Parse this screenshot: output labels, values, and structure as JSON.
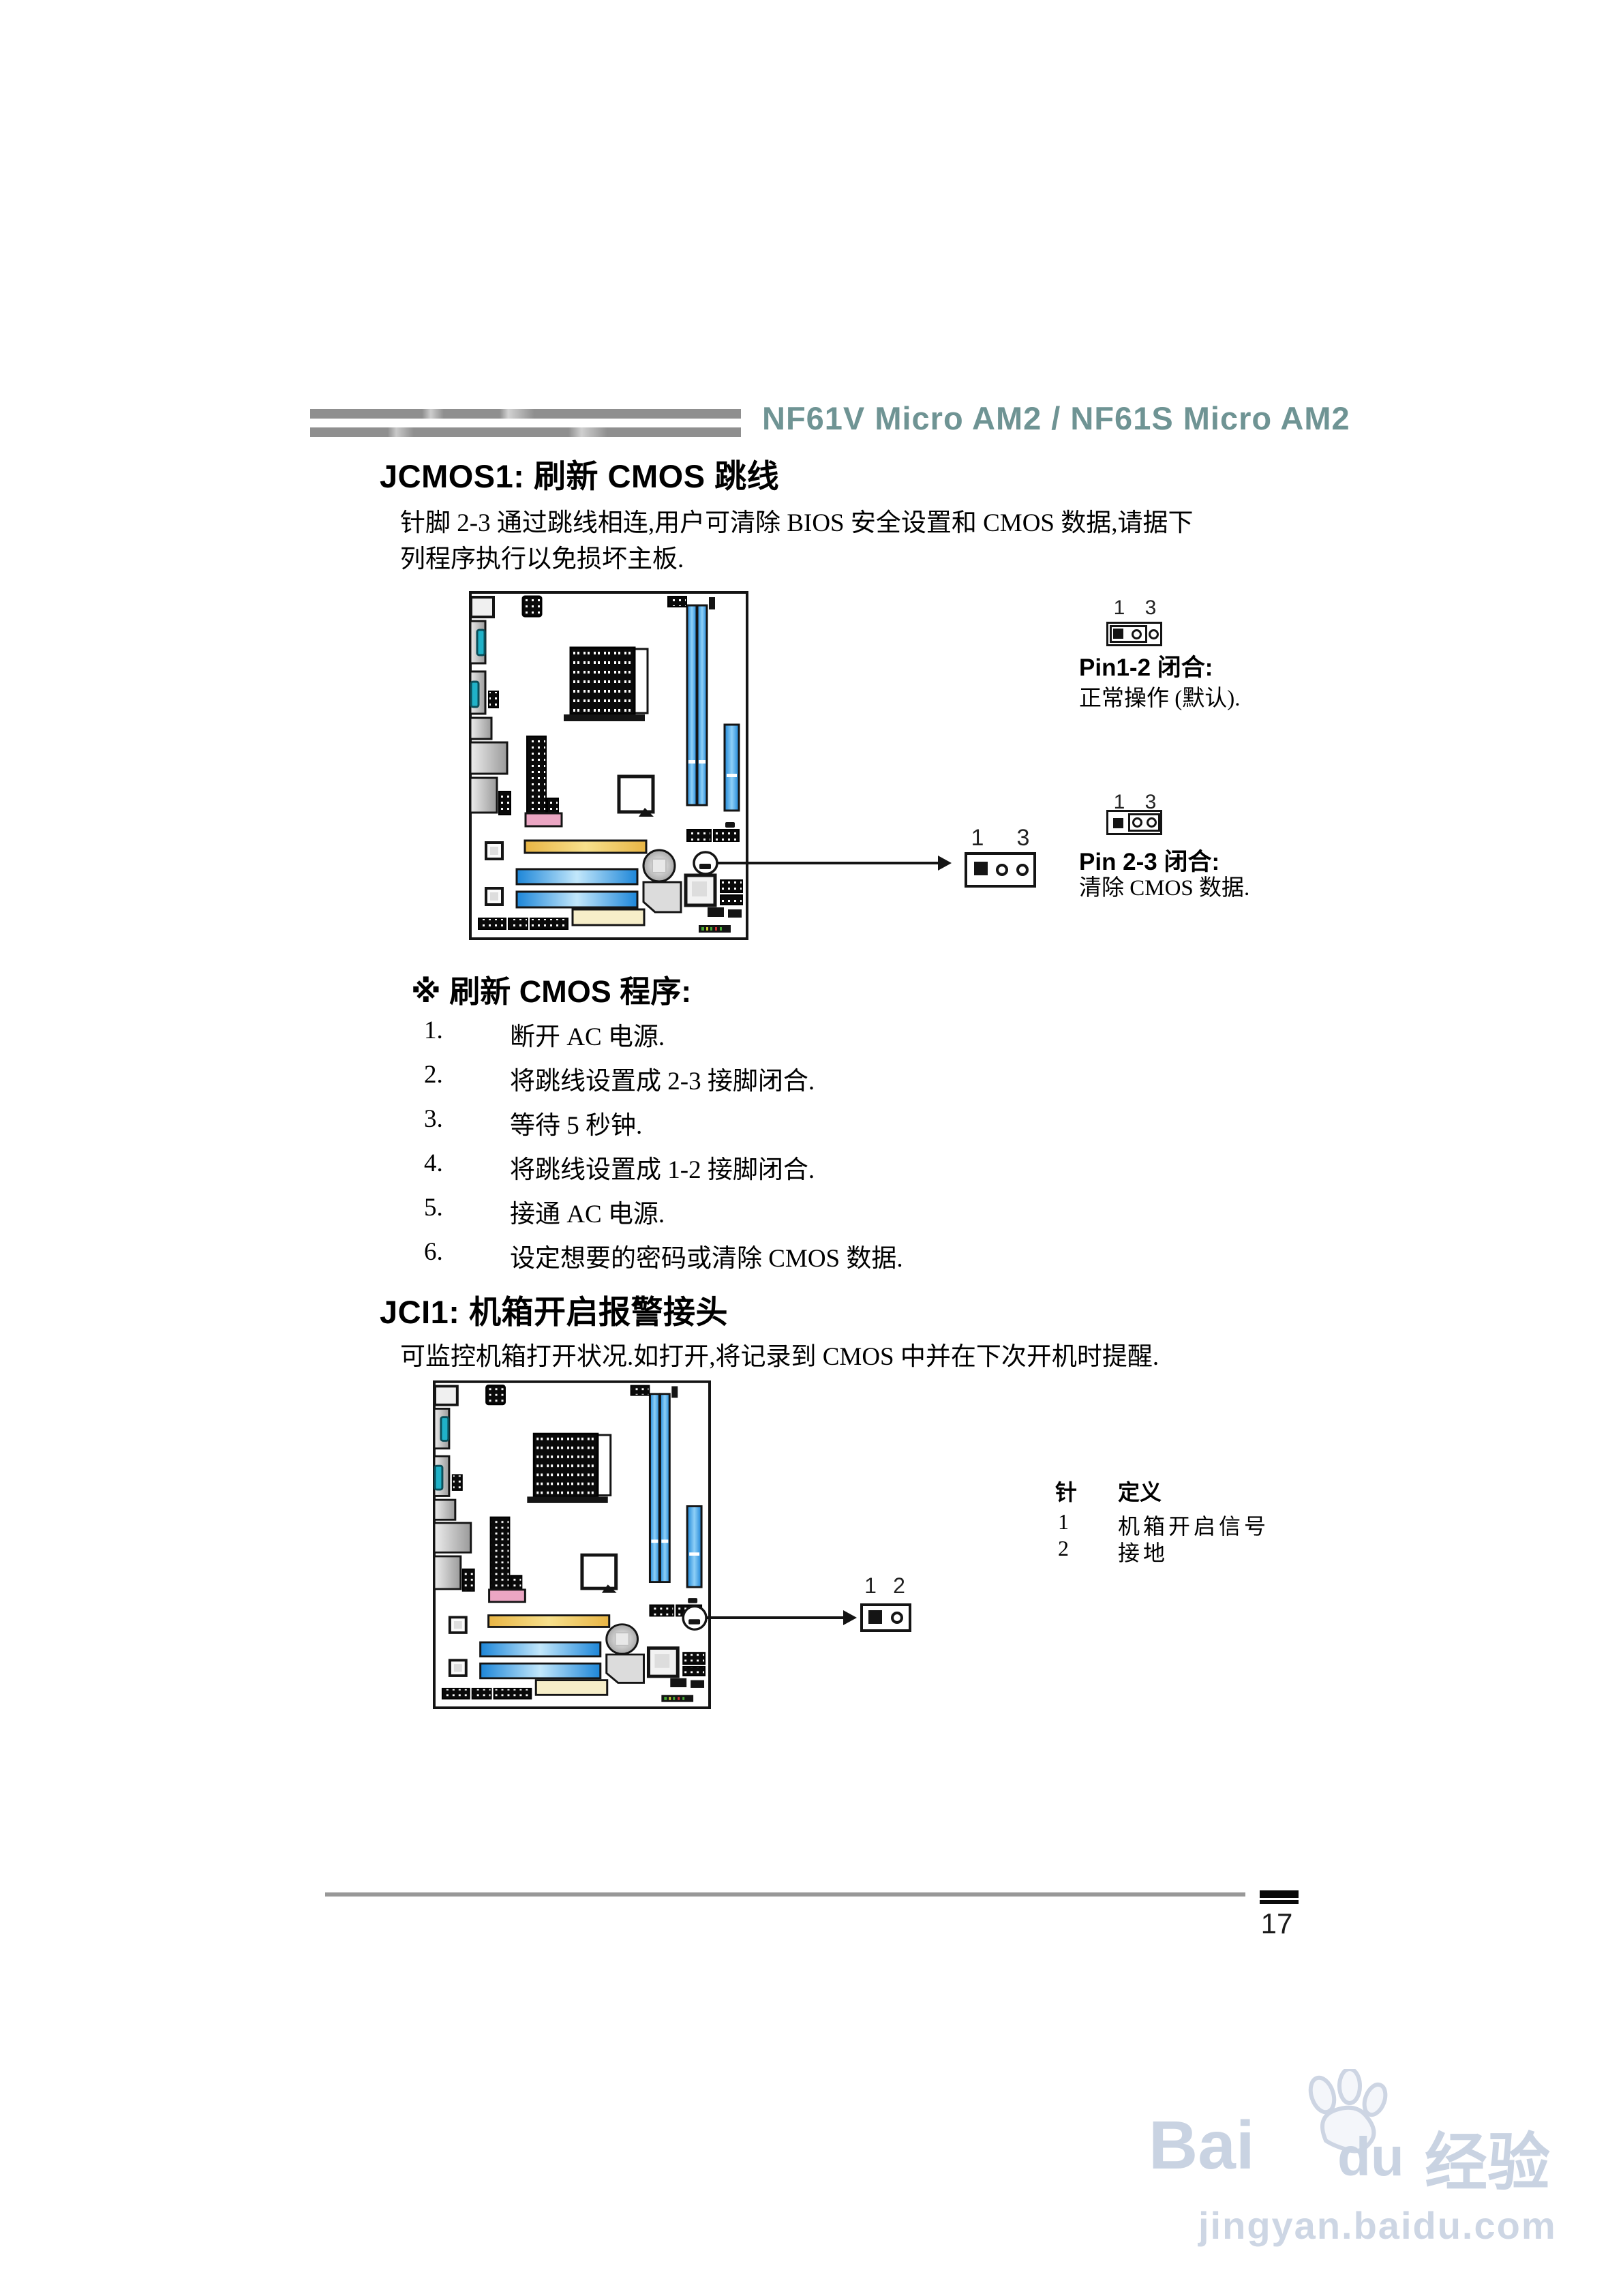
{
  "header": {
    "title": "NF61V Micro AM2 / NF61S Micro AM2"
  },
  "jcmos": {
    "title": "JCMOS1: 刷新 CMOS 跳线",
    "body_line1": "针脚 2-3 通过跳线相连,用户可清除 BIOS 安全设置和 CMOS 数据,请据下",
    "body_line2": "列程序执行以免损坏主板.",
    "jumper_callout": {
      "pin_left": "1",
      "pin_right": "3"
    },
    "pin12": {
      "label_left": "1",
      "label_right": "3",
      "title": "Pin1-2 闭合:",
      "desc": "正常操作 (默认)."
    },
    "pin23": {
      "label_left": "1",
      "label_right": "3",
      "title": "Pin 2-3 闭合:",
      "desc": "清除 CMOS 数据."
    }
  },
  "procedure": {
    "title": "※ 刷新 CMOS 程序:",
    "steps": [
      {
        "num": "1.",
        "text": "断开 AC 电源."
      },
      {
        "num": "2.",
        "text": "将跳线设置成 2-3 接脚闭合."
      },
      {
        "num": "3.",
        "text": "等待 5 秒钟."
      },
      {
        "num": "4.",
        "text": "将跳线设置成 1-2 接脚闭合."
      },
      {
        "num": "5.",
        "text": "接通 AC 电源."
      },
      {
        "num": "6.",
        "text": "设定想要的密码或清除 CMOS 数据."
      }
    ]
  },
  "jci": {
    "title": "JCI1: 机箱开启报警接头",
    "body": "可监控机箱打开状况.如打开,将记录到 CMOS 中并在下次开机时提醒.",
    "jumper_callout": {
      "pin_left": "1",
      "pin_right": "2"
    },
    "pin_table": {
      "col_pin": "针",
      "col_def": "定义",
      "rows": [
        {
          "pin": "1",
          "def": "机箱开启信号"
        },
        {
          "pin": "2",
          "def": "接地"
        }
      ]
    }
  },
  "footer": {
    "page_number": "17"
  },
  "watermark": {
    "brand_bai": "Bai",
    "brand_du": "du",
    "brand_suffix": "经验",
    "url": "jingyan.baidu.com"
  },
  "colors": {
    "header_text": "#6f9494",
    "decoration_bar": "#8f8f8f",
    "slot_blue": "#1d86d8",
    "slot_yellow": "#eebd4e",
    "slot_cream": "#f6eec9",
    "connector_pink": "#eba6c3",
    "port_teal": "#20b2c8",
    "watermark": "#c9d3e2"
  }
}
